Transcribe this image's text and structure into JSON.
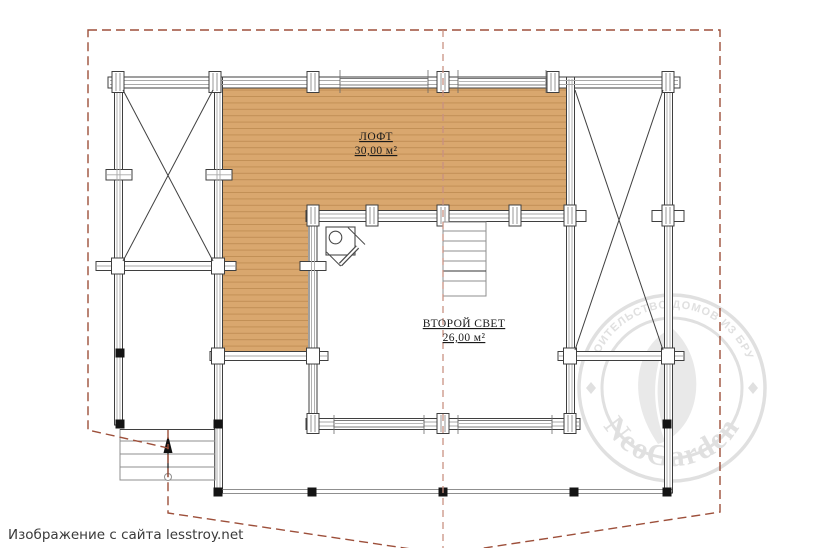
{
  "caption": {
    "text": "Изображение с сайта lesstroy.net"
  },
  "plan": {
    "rooms": [
      {
        "id": "loft",
        "label": "ЛОФТ",
        "area": "30,00 м²"
      },
      {
        "id": "second-light",
        "label": "ВТОРОЙ СВЕТ",
        "area": "26,00 м²"
      }
    ],
    "colors": {
      "wood_fill": "#d9a76e",
      "wood_line": "#bd8a50",
      "wall_stroke": "#3f3f3f",
      "inner_line": "#a9a9a9",
      "light_stroke": "#8f8f8f",
      "dark_tread": "#333333",
      "post_black": "#141414",
      "roof_dash": "#9d4f3a",
      "ridge_dash": "#c99182",
      "label_color": "#1a1a1a"
    }
  },
  "watermark": {
    "arc_text": "СТРОИТЕЛЬСТВО ДОМОВ ИЗ БРУСА",
    "brand": "NeoGarden",
    "color": "#e0e0e0"
  }
}
